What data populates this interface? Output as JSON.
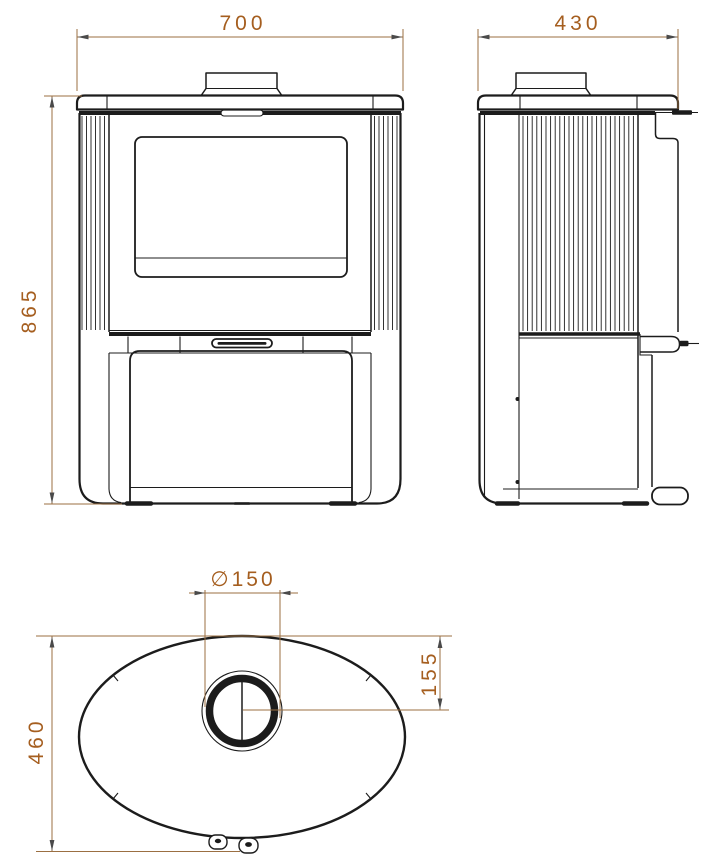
{
  "dimensions": {
    "front_width": "700",
    "depth": "430",
    "height": "865",
    "flue_diameter": "∅150",
    "flue_offset": "155",
    "top_depth": "460"
  },
  "colors": {
    "line": "#1c1c1c",
    "dim_line": "#9b6f42",
    "dim_text": "#a55e1f",
    "arrow": "#4a4a4a",
    "background": "#ffffff"
  }
}
